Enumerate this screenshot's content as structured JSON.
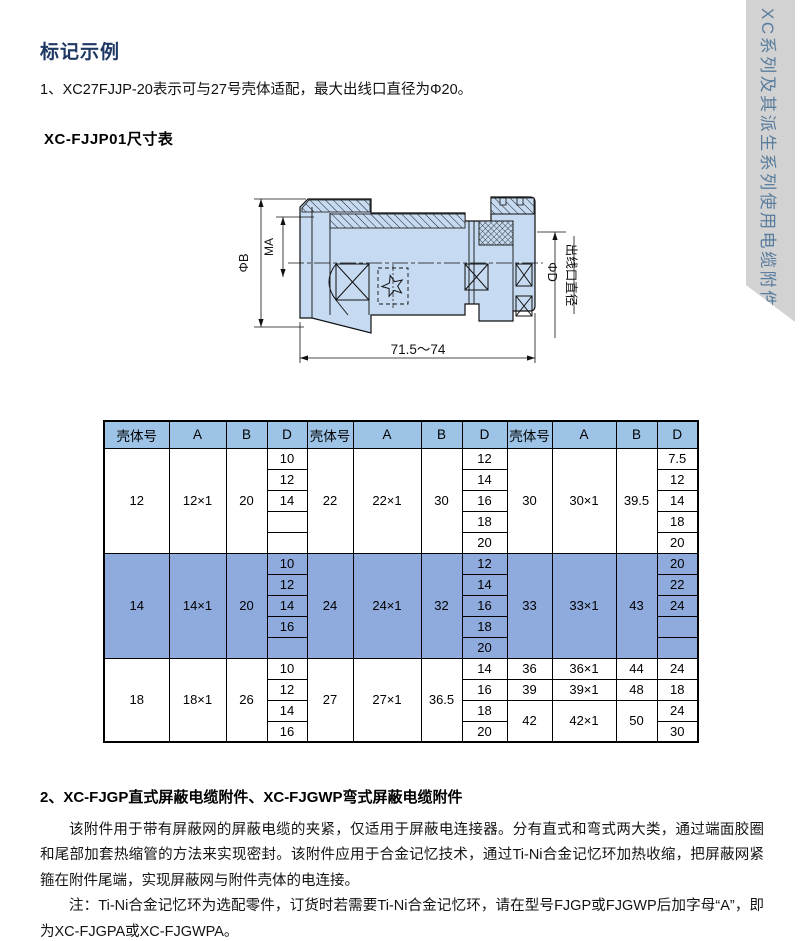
{
  "page": {
    "section1_title": "标记示例",
    "note1": "1、XC27FJJP-20表示可与27号壳体适配，最大出线口直径为Φ20。",
    "table_title": "XC-FJJP01尺寸表",
    "section2_title": "2、XC-FJGP直式屏蔽电缆附件、XC-FJGWP弯式屏蔽电缆附件",
    "para1": "该附件用于带有屏蔽网的屏蔽电缆的夹紧，仅适用于屏蔽电连接器。分有直式和弯式两大类，通过端面胶圈和尾部加套热缩管的方法来实现密封。该附件应用于合金记忆技术，通过Ti-Ni合金记忆环加热收缩，把屏蔽网紧箍在附件尾端，实现屏蔽网与附件壳体的电连接。",
    "para2": "注：Ti-Ni合金记忆环为选配零件，订货时若需要Ti-Ni合金记忆环，请在型号FJGP或FJGWP后加字母“A”，即为XC-FJGPA或XC-FJGWPA。"
  },
  "sidebar": {
    "label": "XC系列及其派生系列使用电缆附件"
  },
  "drawing": {
    "labels": {
      "dia_b": "ΦB",
      "ma": "MA",
      "dia_d": "ΦD",
      "outlet": "出线口直径",
      "length": "71.5～74"
    }
  },
  "colors": {
    "title": "#1f3864",
    "table_header_bg": "#9dc3e6",
    "table_highlight_bg": "#8faadc",
    "sidebar_bg": "#d2d2d2",
    "sidebar_text": "#5a7d9e",
    "drawing_body_fill": "#c6daf1"
  },
  "table": {
    "headers": [
      "壳体号",
      "A",
      "B",
      "D",
      "壳体号",
      "A",
      "B",
      "D",
      "壳体号",
      "A",
      "B",
      "D"
    ],
    "col_widths": [
      65,
      57,
      41,
      40,
      46,
      68,
      41,
      45,
      45,
      64,
      41,
      41
    ],
    "sections": [
      {
        "highlight": false,
        "rows": [
          [
            {
              "t": "12",
              "rs": 5
            },
            {
              "t": "12×1",
              "rs": 5
            },
            {
              "t": "20",
              "rs": 5
            },
            {
              "t": "10"
            },
            {
              "t": "22",
              "rs": 5
            },
            {
              "t": "22×1",
              "rs": 5
            },
            {
              "t": "30",
              "rs": 5
            },
            {
              "t": "12"
            },
            {
              "t": "30",
              "rs": 5
            },
            {
              "t": "30×1",
              "rs": 5
            },
            {
              "t": "39.5",
              "rs": 5
            },
            {
              "t": "7.5"
            }
          ],
          [
            {
              "t": "12"
            },
            {
              "t": "14"
            },
            {
              "t": "12"
            }
          ],
          [
            {
              "t": "14"
            },
            {
              "t": "16"
            },
            {
              "t": "14"
            }
          ],
          [
            {
              "t": ""
            },
            {
              "t": "18"
            },
            {
              "t": "18"
            }
          ],
          [
            {
              "t": ""
            },
            {
              "t": "20"
            },
            {
              "t": "20"
            }
          ]
        ]
      },
      {
        "highlight": true,
        "rows": [
          [
            {
              "t": "14",
              "rs": 5
            },
            {
              "t": "14×1",
              "rs": 5
            },
            {
              "t": "20",
              "rs": 5
            },
            {
              "t": "10"
            },
            {
              "t": "24",
              "rs": 5
            },
            {
              "t": "24×1",
              "rs": 5
            },
            {
              "t": "32",
              "rs": 5
            },
            {
              "t": "12"
            },
            {
              "t": "33",
              "rs": 5
            },
            {
              "t": "33×1",
              "rs": 5
            },
            {
              "t": "43",
              "rs": 5
            },
            {
              "t": "20"
            }
          ],
          [
            {
              "t": "12"
            },
            {
              "t": "14"
            },
            {
              "t": "22"
            }
          ],
          [
            {
              "t": "14"
            },
            {
              "t": "16"
            },
            {
              "t": "24"
            }
          ],
          [
            {
              "t": "16"
            },
            {
              "t": "18"
            },
            {
              "t": ""
            }
          ],
          [
            {
              "t": ""
            },
            {
              "t": "20"
            },
            {
              "t": ""
            }
          ]
        ]
      },
      {
        "highlight": false,
        "rows": [
          [
            {
              "t": "18",
              "rs": 4
            },
            {
              "t": "18×1",
              "rs": 4
            },
            {
              "t": "26",
              "rs": 4
            },
            {
              "t": "10"
            },
            {
              "t": "27",
              "rs": 4
            },
            {
              "t": "27×1",
              "rs": 4
            },
            {
              "t": "36.5",
              "rs": 4
            },
            {
              "t": "14"
            },
            {
              "t": "36"
            },
            {
              "t": "36×1"
            },
            {
              "t": "44"
            },
            {
              "t": "24"
            }
          ],
          [
            {
              "t": "12"
            },
            {
              "t": "16"
            },
            {
              "t": "39"
            },
            {
              "t": "39×1"
            },
            {
              "t": "48"
            },
            {
              "t": "18"
            }
          ],
          [
            {
              "t": "14"
            },
            {
              "t": "18"
            },
            {
              "t": "42",
              "rs": 2
            },
            {
              "t": "42×1",
              "rs": 2
            },
            {
              "t": "50",
              "rs": 2
            },
            {
              "t": "24"
            }
          ],
          [
            {
              "t": "16"
            },
            {
              "t": "20"
            },
            {
              "t": "30"
            }
          ]
        ]
      }
    ]
  }
}
